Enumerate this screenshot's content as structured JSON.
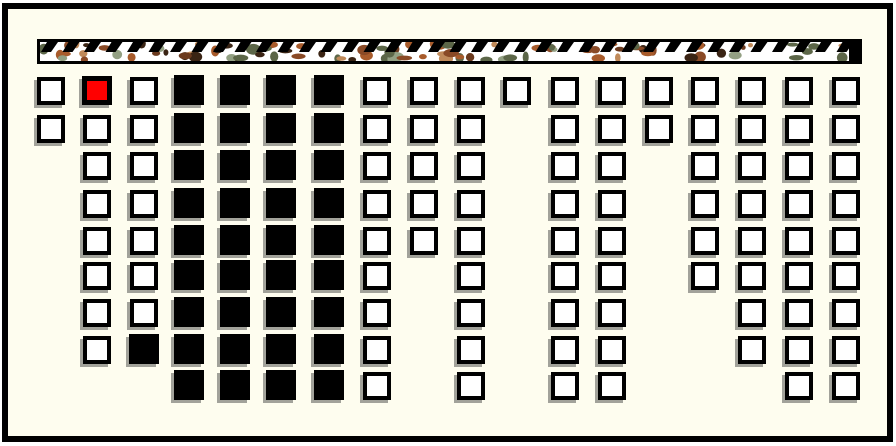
{
  "window": {
    "background": "#FFFFFF",
    "frame_fill": "#FEFDEF",
    "frame_border": "#000000"
  },
  "textured_strip": {
    "description": "horizontal bar filled with camouflage blobs and black diagonal hatch marks",
    "background": "#FFFFFF",
    "border_color": "#000000",
    "hatch_color": "#000000",
    "camo_palette": [
      "#8A4A26",
      "#A85B2B",
      "#3A2414",
      "#6B3A1E",
      "#5C6648",
      "#93A083",
      "#C08A5A"
    ]
  },
  "board": {
    "rows": 9,
    "columns": 18,
    "cell_states": {
      "O": "outline",
      "X": "filled",
      "R": "highlighted",
      ".": "empty"
    },
    "colors": {
      "outline_fill": "#FFFFFF",
      "filled_fill": "#000000",
      "highlight_fill": "#FF0000",
      "cell_border": "#000000",
      "cell_shadow": "#A2A29A"
    },
    "grid": [
      "OROXXXXOOOOOOOOOOO",
      "OOOXXXXOOO.OOOOOOO",
      ".OOXXXXOOO.OO.OOOO",
      ".OOXXXXOOO.OO.OOOO",
      ".OOXXXXOOO.OO.OOOO",
      ".OOXXXXO.O.OO.OOOO",
      ".OOXXXXO.O.OO..OOO",
      ".OXXXXXO.O.OO..OOO",
      "...XXXXO.O.OO...OO"
    ]
  }
}
